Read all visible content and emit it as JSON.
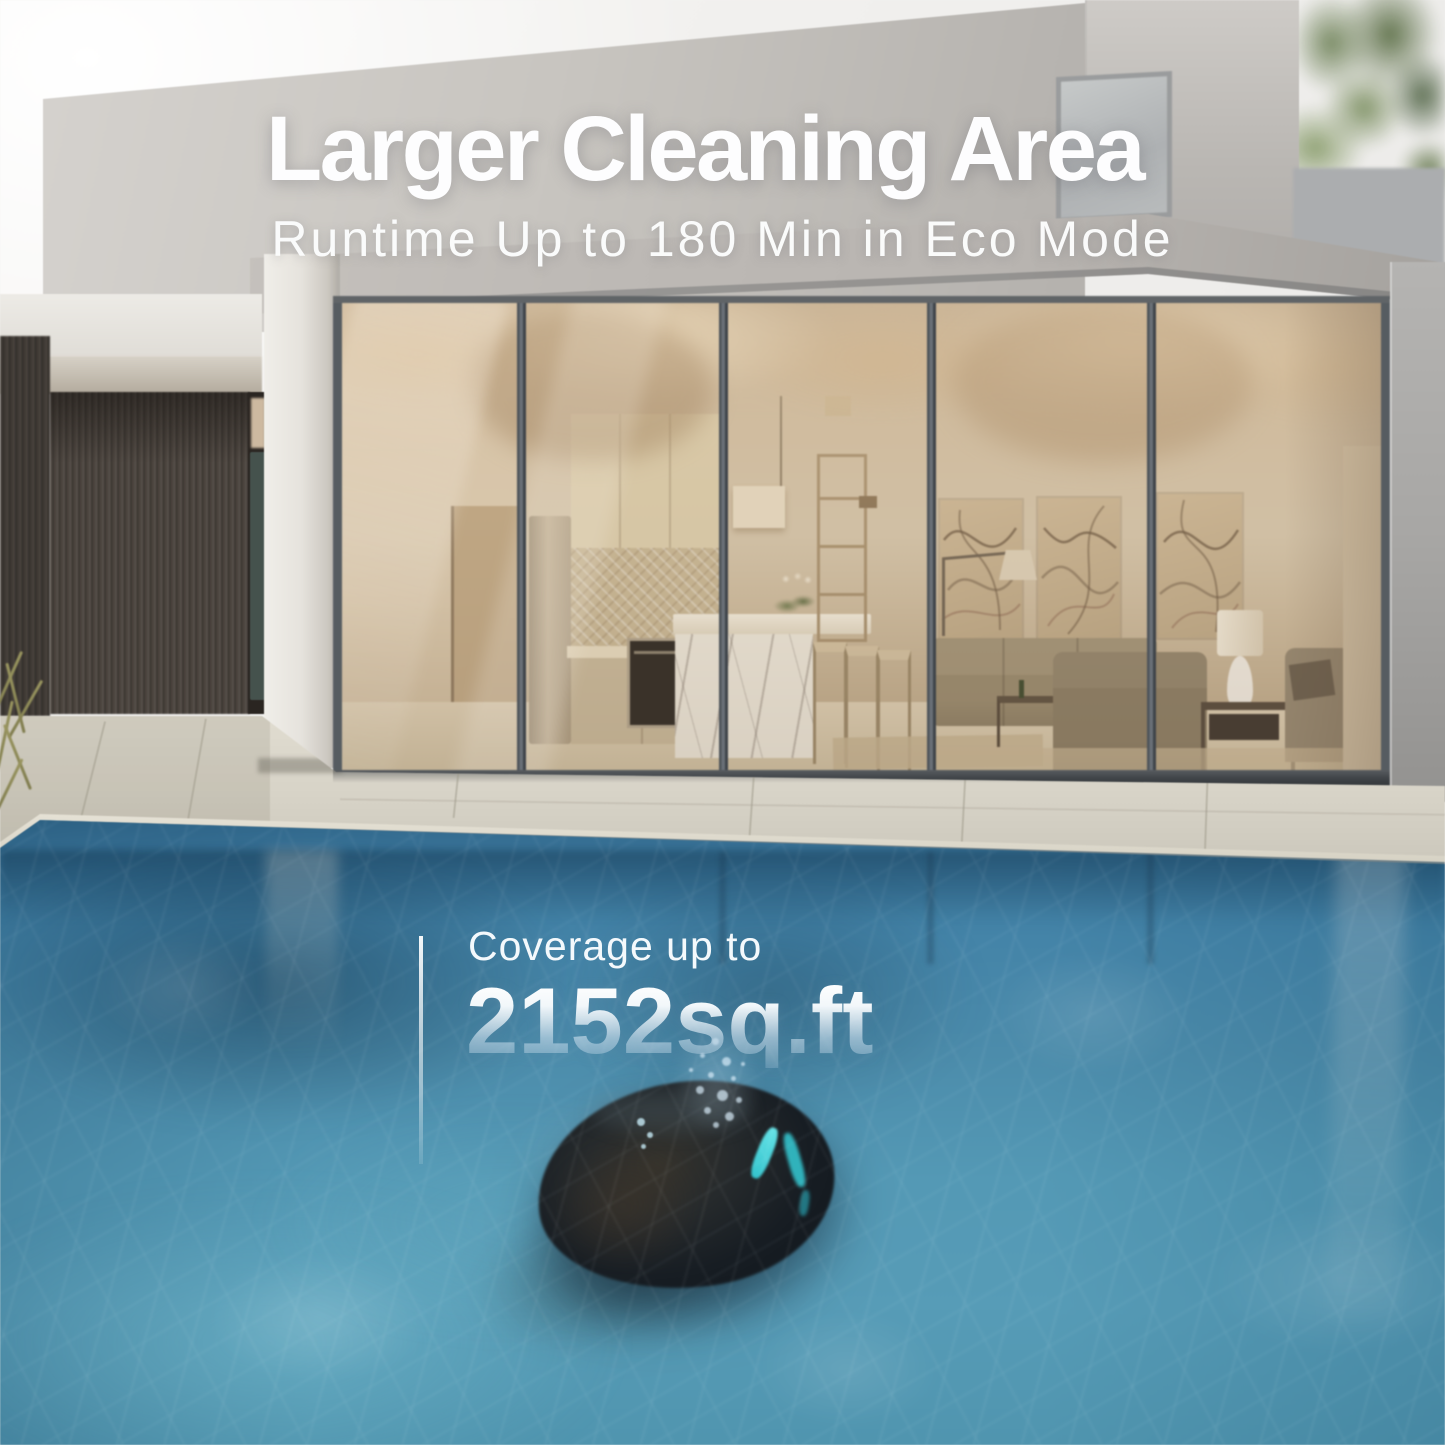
{
  "overlay": {
    "title": "Larger Cleaning Area",
    "subtitle": "Runtime Up to 180 Min in Eco Mode",
    "coverage": {
      "label": "Coverage up to",
      "value": "2152sq.ft"
    }
  },
  "palette": {
    "sky": "#f3f2f0",
    "wall_light": "#d6d3cf",
    "wall_shadow": "#aba8a4",
    "fascia": "#b9b5b1",
    "slat_wood": "#4a443e",
    "glass_warm": "#d3c2a7",
    "glass_frame": "#565c61",
    "terrace": "#d8d4c8",
    "coping": "#e8e4d8",
    "water_deep": "#2f6588",
    "water_mid": "#4c8cab",
    "water_light": "#79b4c8",
    "robot_body": "#171d23",
    "robot_accent": "#35ccd6",
    "splash": "#d8ecf6",
    "text_white": "#fdfdfe"
  }
}
